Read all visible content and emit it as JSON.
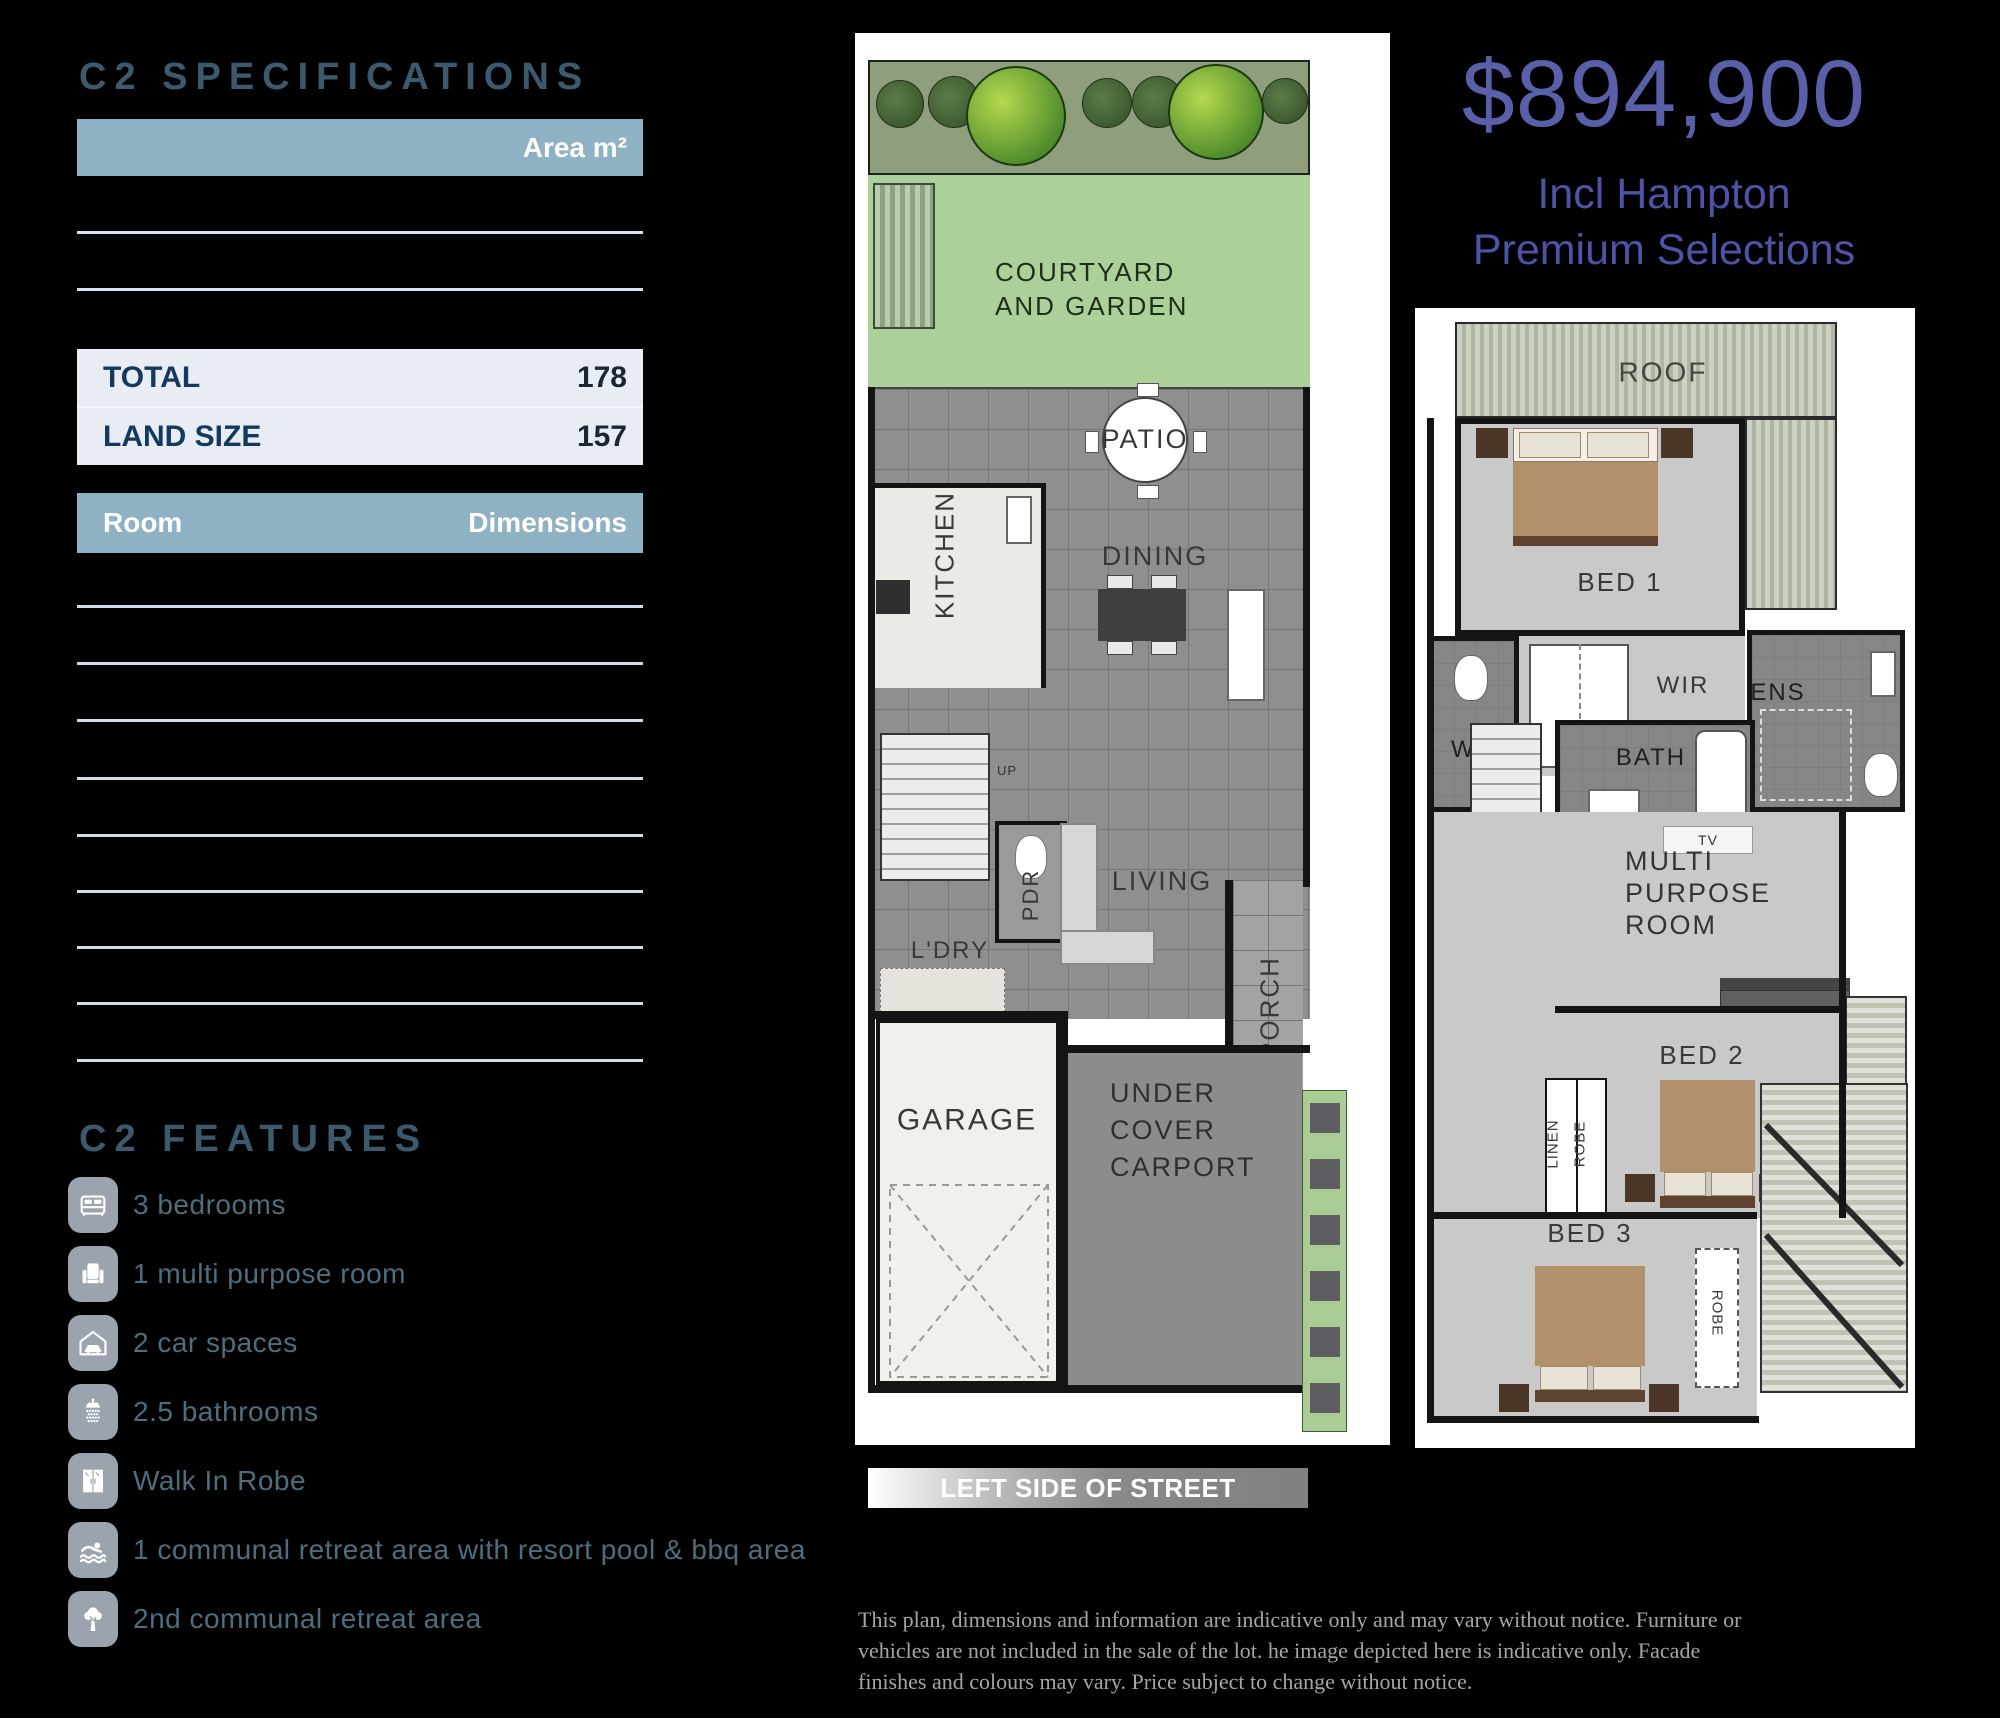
{
  "specifications": {
    "title": "C2 SPECIFICATIONS",
    "area_header": "Area m²",
    "rows": [
      {
        "label": "TOTAL",
        "value": "178"
      },
      {
        "label": "LAND SIZE",
        "value": "157"
      }
    ],
    "room_header": {
      "room": "Room",
      "dimensions": "Dimensions"
    }
  },
  "features": {
    "title": "C2 FEATURES",
    "items": [
      {
        "icon": "bed-icon",
        "label": "3 bedrooms"
      },
      {
        "icon": "armchair-icon",
        "label": "1 multi purpose room"
      },
      {
        "icon": "car-garage-icon",
        "label": "2 car spaces"
      },
      {
        "icon": "shower-icon",
        "label": "2.5 bathrooms"
      },
      {
        "icon": "wardrobe-icon",
        "label": "Walk In Robe"
      },
      {
        "icon": "swimmer-icon",
        "label": "1 communal retreat area with resort pool & bbq area"
      },
      {
        "icon": "tree-icon",
        "label": "2nd communal retreat area"
      }
    ]
  },
  "price": {
    "amount": "$894,900",
    "subtitle_line1": "Incl Hampton",
    "subtitle_line2": "Premium Selections"
  },
  "ground_floor": {
    "courtyard": "COURTYARD\nAND GARDEN",
    "patio": "PATIO",
    "kitchen": "KITCHEN",
    "dining": "DINING",
    "up": "UP",
    "pdr": "PDR",
    "ldry": "L'DRY",
    "living": "LIVING",
    "porch": "PORCH",
    "garage": "GARAGE",
    "carport": "UNDER\nCOVER\nCARPORT"
  },
  "first_floor": {
    "roof": "ROOF",
    "bed1": "BED 1",
    "wc": "WC",
    "wir": "WIR",
    "ens": "ENS",
    "bath": "BATH",
    "tv": "TV",
    "multi_purpose": "MULTI\nPURPOSE\nROOM",
    "dn": "DN",
    "bed2": "BED 2",
    "linen": "LINEN",
    "robe_bed2": "ROBE",
    "bed3": "BED 3",
    "robe_bed3": "ROBE"
  },
  "street_banner": "LEFT SIDE OF STREET",
  "disclaimer": "This plan, dimensions and information are indicative only and may vary without notice. Furniture or vehicles are not included in the sale of the lot.  he image depicted here is indicative only. Facade finishes and colours may vary. Price subject to change without notice.",
  "colors": {
    "background": "#000000",
    "table_header_blue": "#8fb1c4",
    "table_row_light": "#e7edf3",
    "heading_slate": "#3b5a6e",
    "navy_text": "#14395e",
    "feature_text": "#4e6e7e",
    "feature_icon_bg": "#9ba4ae",
    "price_purple": "#5a5fa9",
    "courtyard_green": "#abd09a",
    "garden_olive": "#8f9e7c"
  }
}
